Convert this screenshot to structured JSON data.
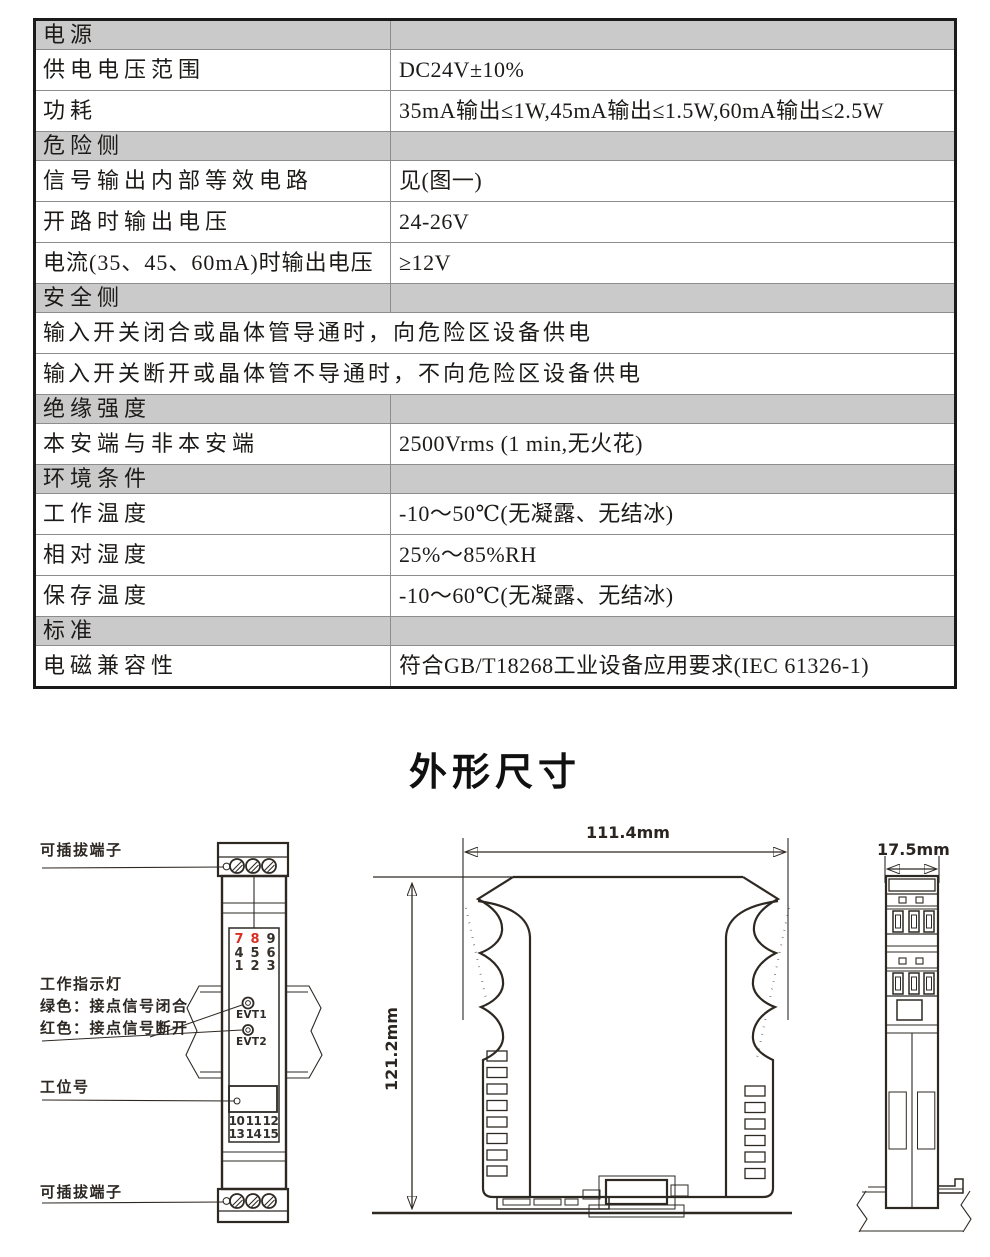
{
  "table": {
    "rows": [
      {
        "type": "section",
        "label": "电源"
      },
      {
        "type": "kv",
        "key": "供电电压范围",
        "value": "DC24V±10%"
      },
      {
        "type": "kv",
        "key": "功耗",
        "value": "35mA输出≤1W,45mA输出≤1.5W,60mA输出≤2.5W"
      },
      {
        "type": "section",
        "label": "危险侧"
      },
      {
        "type": "kv",
        "key": "信号输出内部等效电路",
        "value": "见(图一)"
      },
      {
        "type": "kv",
        "key": "开路时输出电压",
        "value": "24-26V"
      },
      {
        "type": "kv",
        "key": "电流(35、45、60mA)时输出电压",
        "value": "≥12V"
      },
      {
        "type": "section",
        "label": "安全侧"
      },
      {
        "type": "full",
        "label": "输入开关闭合或晶体管导通时，向危险区设备供电"
      },
      {
        "type": "full",
        "label": "输入开关断开或晶体管不导通时，不向危险区设备供电"
      },
      {
        "type": "section",
        "label": "绝缘强度"
      },
      {
        "type": "kv",
        "key": "本安端与非本安端",
        "value": "2500Vrms (1 min,无火花)"
      },
      {
        "type": "section",
        "label": "环境条件"
      },
      {
        "type": "kv",
        "key": "工作温度",
        "value": "-10～50℃(无凝露、无结冰)"
      },
      {
        "type": "kv",
        "key": "相对湿度",
        "value": "25%～85%RH"
      },
      {
        "type": "kv",
        "key": "保存温度",
        "value": "-10～60℃(无凝露、无结冰)"
      },
      {
        "type": "section",
        "label": "标准"
      },
      {
        "type": "kv",
        "key": "电磁兼容性",
        "value": "符合GB/T18268工业设备应用要求(IEC 61326-1)"
      }
    ]
  },
  "diagram": {
    "title": "外形尺寸",
    "front_view": {
      "label_top_terminal": "可插拔端子",
      "label_indicator": "工作指示灯",
      "label_indicator_green": "绿色：接点信号闭合",
      "label_indicator_red": "红色：接点信号断开",
      "label_tag": "工位号",
      "label_bottom_terminal": "可插拔端子",
      "top_numbers": [
        [
          "7",
          "8",
          "9"
        ],
        [
          "4",
          "5",
          "6"
        ],
        [
          "1",
          "2",
          "3"
        ]
      ],
      "red_numbers": [
        "7",
        "8"
      ],
      "leds": [
        "EVT1",
        "EVT2"
      ],
      "bottom_numbers": [
        [
          "10",
          "11",
          "12"
        ],
        [
          "13",
          "14",
          "15"
        ]
      ]
    },
    "side_view": {
      "width_dim": "111.4mm",
      "height_dim": "121.2mm"
    },
    "end_view": {
      "width_dim": "17.5mm"
    },
    "colors": {
      "red": "#d92f23",
      "line": "#2e2823",
      "section_gray": "#cacaca"
    }
  }
}
